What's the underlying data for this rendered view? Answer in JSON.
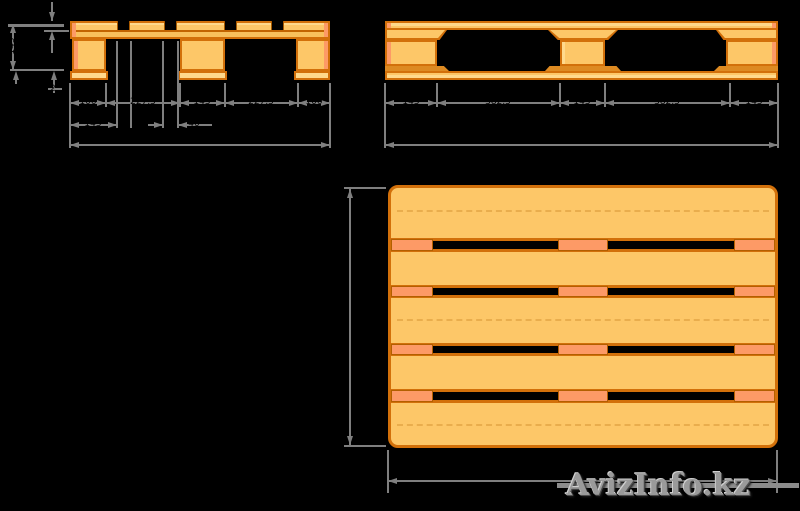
{
  "drawing": {
    "subject": "wooden euro pallet technical drawing",
    "background_color": "#000000",
    "colors": {
      "wood_light": "#FDC768",
      "wood_highlight": "#FFD98C",
      "wood_end_grain_salmon": "#FD9A66",
      "outline_orange": "#D2700A",
      "dimension_line_gray": "#7F7F7F",
      "dimension_text": "#000000"
    }
  },
  "end_view": {
    "dims_row1": [
      "100",
      "227,5",
      "145",
      "227,5",
      "100"
    ],
    "dim_deck_board_width": "145",
    "dim_deck_board_gap": "40",
    "dim_total_width": "800",
    "dim_top_board_thickness": "22",
    "dim_overall_height": "145",
    "dim_bottom_board_thickness": "22"
  },
  "side_view": {
    "dims_row1": [
      "145",
      "382,5",
      "145",
      "382,5",
      "145"
    ],
    "dim_total_length": "1200"
  },
  "top_view": {
    "dim_width": "800",
    "dim_length": "1200"
  },
  "watermark": {
    "text": "AvizInfo.kz"
  }
}
